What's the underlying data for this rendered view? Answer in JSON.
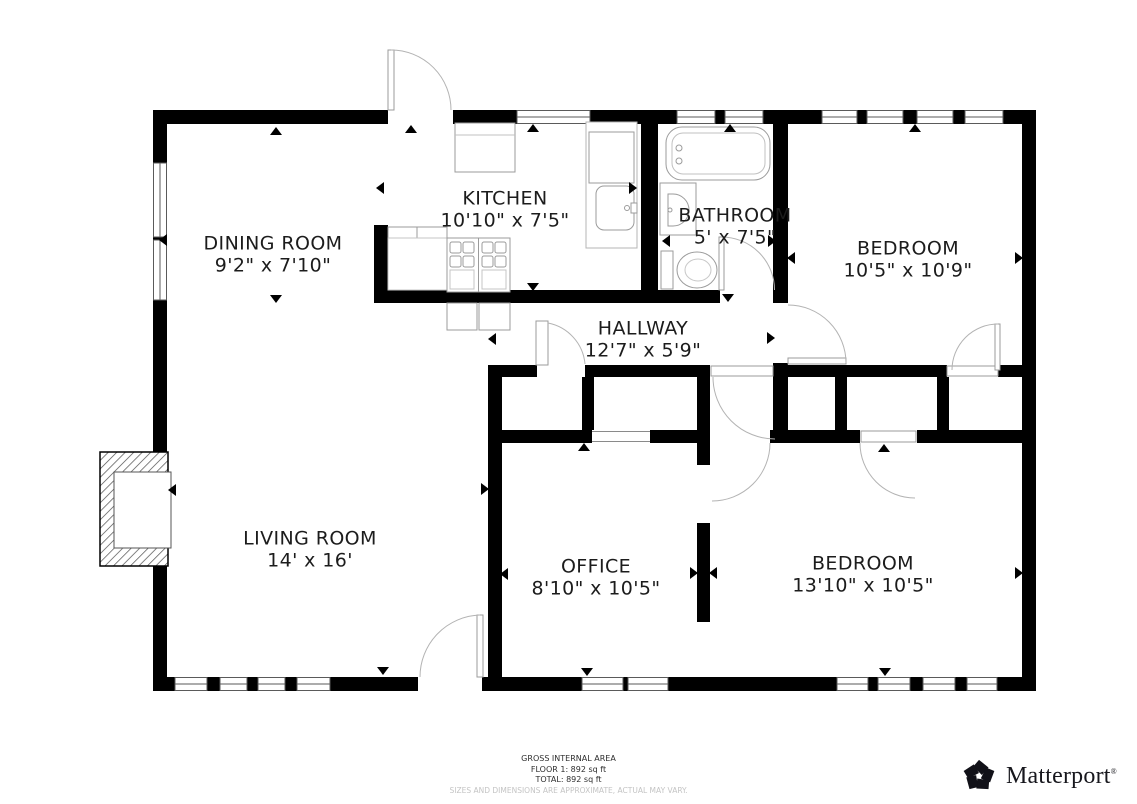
{
  "rooms": [
    {
      "name": "DINING ROOM",
      "dims": "9'2\" x 7'10\""
    },
    {
      "name": "KITCHEN",
      "dims": "10'10\" x 7'5\""
    },
    {
      "name": "BATHROOM",
      "dims": "5' x 7'5\""
    },
    {
      "name": "BEDROOM",
      "dims": "10'5\" x 10'9\""
    },
    {
      "name": "HALLWAY",
      "dims": "12'7\" x 5'9\""
    },
    {
      "name": "LIVING ROOM",
      "dims": "14' x 16'"
    },
    {
      "name": "OFFICE",
      "dims": "8'10\" x 10'5\""
    },
    {
      "name": "BEDROOM",
      "dims": "13'10\" x 10'5\""
    }
  ],
  "footer": {
    "gross_label": "GROSS INTERNAL AREA",
    "floor_line": "FLOOR 1: 892 sq ft",
    "total_line": "TOTAL: 892 sq ft",
    "disclaimer": "SIZES AND DIMENSIONS ARE APPROXIMATE, ACTUAL MAY VARY."
  },
  "brand": {
    "name": "Matterport",
    "registered": "®"
  },
  "colors": {
    "wall": "#000000",
    "fixture_stroke": "#999999",
    "label_text": "#1c1c1c",
    "disclaimer_text": "#c4c4c4",
    "brand_text": "#17171d"
  }
}
